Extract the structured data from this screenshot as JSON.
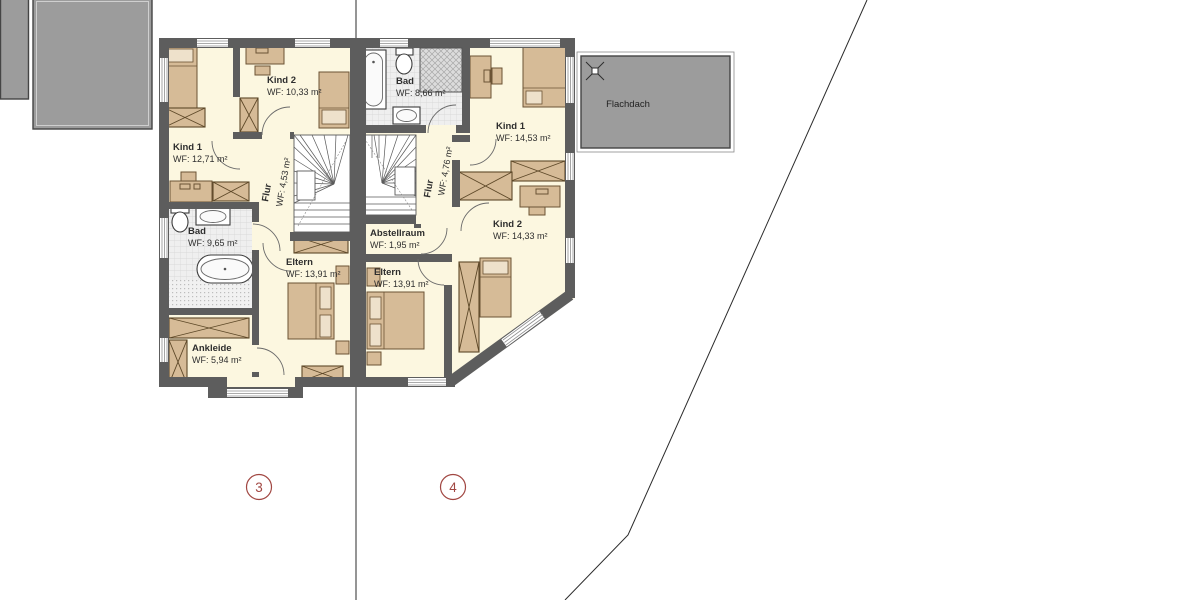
{
  "plan": {
    "left_unit": {
      "marker": "3",
      "rooms": {
        "kind1": {
          "name": "Kind 1",
          "area": "WF: 12,71 m²"
        },
        "kind2": {
          "name": "Kind 2",
          "area": "WF: 10,33 m²"
        },
        "flur": {
          "name": "Flur",
          "area": "WF: 4,53 m²"
        },
        "bad": {
          "name": "Bad",
          "area": "WF: 9,65 m²"
        },
        "eltern": {
          "name": "Eltern",
          "area": "WF: 13,91 m²"
        },
        "ankleide": {
          "name": "Ankleide",
          "area": "WF: 5,94 m²"
        }
      }
    },
    "right_unit": {
      "marker": "4",
      "rooms": {
        "bad": {
          "name": "Bad",
          "area": "WF: 8,66 m²"
        },
        "kind1": {
          "name": "Kind 1",
          "area": "WF: 14,53 m²"
        },
        "flur": {
          "name": "Flur",
          "area": "WF: 4,76 m²"
        },
        "abstellraum": {
          "name": "Abstellraum",
          "area": "WF: 1,95 m²"
        },
        "kind2": {
          "name": "Kind 2",
          "area": "WF: 14,33 m²"
        },
        "eltern": {
          "name": "Eltern",
          "area": "WF: 13,91 m²"
        }
      }
    },
    "roof_label": "Flachdach",
    "colors": {
      "wall": "#5d5d5d",
      "floor": "#fcf7e0",
      "furniture": "#d6bb97",
      "flat_roof": "#9c9c9c",
      "marker_red": "#a14742",
      "bath_tile": "#efefef"
    }
  }
}
